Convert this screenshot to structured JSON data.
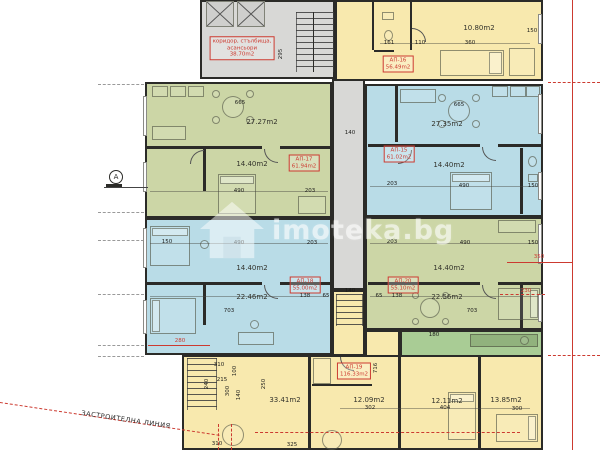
{
  "watermark": {
    "text": "imoteka.bg",
    "logo": "house-icon"
  },
  "stair_core": {
    "lines": [
      "коридор, стълбища,",
      "асансьори",
      "38.70m2"
    ]
  },
  "annotations": {
    "building_line": "ЗАСТРОИТЕЛНА ЛИНИЯ",
    "axis": "А"
  },
  "apartments": [
    {
      "id": "АП-15",
      "area": "61.02m2",
      "color_key": "blue",
      "tag_x": 399,
      "tag_y": 154
    },
    {
      "id": "АП-16",
      "area": "56.49m2",
      "color_key": "yellow",
      "tag_x": 398,
      "tag_y": 64
    },
    {
      "id": "АП-17",
      "area": "61.94m2",
      "color_key": "green",
      "tag_x": 304,
      "tag_y": 163
    },
    {
      "id": "АП-18",
      "area": "55.00m2",
      "color_key": "blue",
      "tag_x": 305,
      "tag_y": 285
    },
    {
      "id": "АП-19",
      "area": "116.33m2",
      "color_key": "yellow",
      "tag_x": 354,
      "tag_y": 371
    },
    {
      "id": "АП-20",
      "area": "55.10m2",
      "color_key": "green",
      "tag_x": 403,
      "tag_y": 285
    }
  ],
  "room_labels": [
    {
      "t": "27.27m2",
      "x": 262,
      "y": 122
    },
    {
      "t": "14.40m2",
      "x": 252,
      "y": 164
    },
    {
      "t": "27.35m2",
      "x": 447,
      "y": 124
    },
    {
      "t": "14.40m2",
      "x": 449,
      "y": 165
    },
    {
      "t": "14.40m2",
      "x": 252,
      "y": 268
    },
    {
      "t": "22.46m2",
      "x": 252,
      "y": 297
    },
    {
      "t": "14.40m2",
      "x": 449,
      "y": 268
    },
    {
      "t": "22.56m2",
      "x": 447,
      "y": 297
    },
    {
      "t": "10.80m2",
      "x": 479,
      "y": 28
    },
    {
      "t": "33.41m2",
      "x": 285,
      "y": 400
    },
    {
      "t": "12.09m2",
      "x": 369,
      "y": 400
    },
    {
      "t": "12.11m2",
      "x": 447,
      "y": 401
    },
    {
      "t": "13.85m2",
      "x": 506,
      "y": 400
    }
  ],
  "dimensions": [
    {
      "t": "665",
      "x": 240,
      "y": 103
    },
    {
      "t": "665",
      "x": 459,
      "y": 105
    },
    {
      "t": "140",
      "x": 350,
      "y": 133
    },
    {
      "t": "490",
      "x": 239,
      "y": 191
    },
    {
      "t": "203",
      "x": 310,
      "y": 191
    },
    {
      "t": "203",
      "x": 392,
      "y": 184
    },
    {
      "t": "490",
      "x": 464,
      "y": 186
    },
    {
      "t": "150",
      "x": 533,
      "y": 186
    },
    {
      "t": "150",
      "x": 167,
      "y": 242
    },
    {
      "t": "490",
      "x": 239,
      "y": 243
    },
    {
      "t": "203",
      "x": 312,
      "y": 243
    },
    {
      "t": "203",
      "x": 392,
      "y": 242
    },
    {
      "t": "490",
      "x": 465,
      "y": 243
    },
    {
      "t": "150",
      "x": 533,
      "y": 243
    },
    {
      "t": "138",
      "x": 305,
      "y": 296
    },
    {
      "t": "65",
      "x": 326,
      "y": 296
    },
    {
      "t": "65",
      "x": 379,
      "y": 296
    },
    {
      "t": "138",
      "x": 397,
      "y": 296
    },
    {
      "t": "703",
      "x": 229,
      "y": 311
    },
    {
      "t": "703",
      "x": 472,
      "y": 311
    },
    {
      "t": "140",
      "x": 350,
      "y": 291
    },
    {
      "t": "360",
      "x": 470,
      "y": 43
    },
    {
      "t": "110",
      "x": 420,
      "y": 43
    },
    {
      "t": "161",
      "x": 389,
      "y": 43
    },
    {
      "t": "150",
      "x": 532,
      "y": 31
    },
    {
      "t": "295",
      "x": 281,
      "y": 54,
      "v": 1
    },
    {
      "t": "310",
      "x": 219,
      "y": 365
    },
    {
      "t": "100",
      "x": 235,
      "y": 371,
      "v": 1
    },
    {
      "t": "215",
      "x": 222,
      "y": 380
    },
    {
      "t": "240",
      "x": 207,
      "y": 384,
      "v": 1
    },
    {
      "t": "300",
      "x": 228,
      "y": 391,
      "v": 1
    },
    {
      "t": "140",
      "x": 239,
      "y": 395,
      "v": 1
    },
    {
      "t": "250",
      "x": 264,
      "y": 384,
      "v": 1
    },
    {
      "t": "302",
      "x": 370,
      "y": 408
    },
    {
      "t": "404",
      "x": 445,
      "y": 408
    },
    {
      "t": "300",
      "x": 517,
      "y": 409
    },
    {
      "t": "310",
      "x": 217,
      "y": 444
    },
    {
      "t": "325",
      "x": 292,
      "y": 445
    },
    {
      "t": "180",
      "x": 434,
      "y": 335
    },
    {
      "t": "716",
      "x": 376,
      "y": 368,
      "v": 1
    },
    {
      "t": "280",
      "x": 180,
      "y": 341,
      "red": 1
    },
    {
      "t": "350",
      "x": 539,
      "y": 257,
      "red": 1
    },
    {
      "t": "230",
      "x": 526,
      "y": 291,
      "red": 1
    }
  ],
  "colors": {
    "green": "#ccd6a6",
    "blue": "#b9dce7",
    "yellow": "#f8e9ae",
    "gray": "#d8d8d6",
    "terrace": "#a9cc95",
    "red": "#cc3a30",
    "wall": "#2b2b28"
  }
}
